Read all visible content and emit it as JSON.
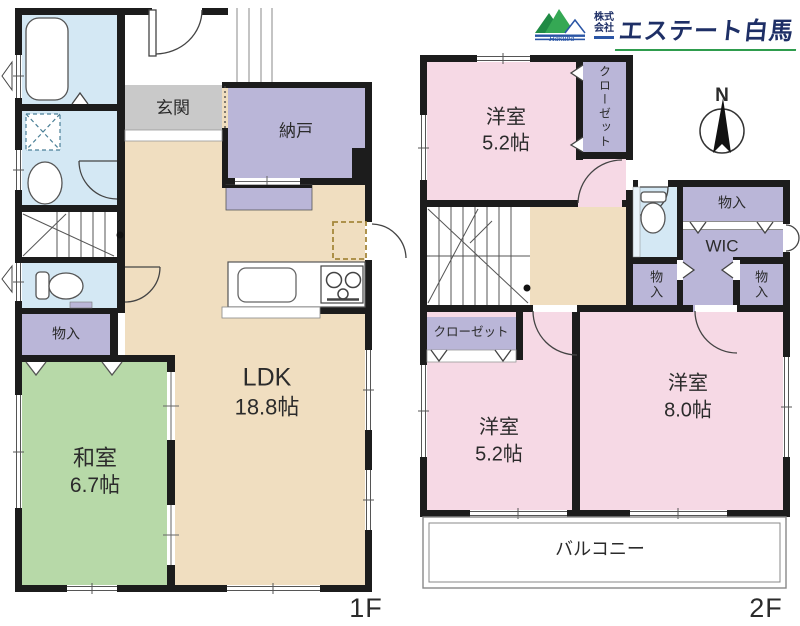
{
  "logo": {
    "prefix_top": "株式",
    "prefix_bottom": "会社",
    "company_name": "エステート白馬",
    "script": "Hakuba"
  },
  "compass": {
    "north": "N"
  },
  "floor1": {
    "label": "1F",
    "genkan": "玄関",
    "nando": "納戸",
    "ldk": {
      "name": "LDK",
      "size": "18.8帖"
    },
    "washitsu": {
      "name": "和室",
      "size": "6.7帖"
    },
    "monoire": "物入"
  },
  "floor2": {
    "label": "2F",
    "room_top": {
      "name": "洋室",
      "size": "5.2帖"
    },
    "closet_top": "クローゼット",
    "monoire_top": "物入",
    "wic": "WIC",
    "monoire_left": "物入",
    "monoire_right": "物入",
    "closet_bottom": "クローゼット",
    "room_left": {
      "name": "洋室",
      "size": "5.2帖"
    },
    "room_right": {
      "name": "洋室",
      "size": "8.0帖"
    },
    "balcony": "バルコニー"
  },
  "colors": {
    "wall": "#1c1c1c",
    "floor": "#f0dec0",
    "storage": "#bab6d8",
    "pink": "#f6d9e5",
    "tatami": "#b7d9a8",
    "water": "#d4e8f4",
    "entrance": "#c9c9c9",
    "brand_navy": "#1e2f66",
    "brand_green": "#2e9c4d",
    "brand_blue": "#2a55a5"
  }
}
